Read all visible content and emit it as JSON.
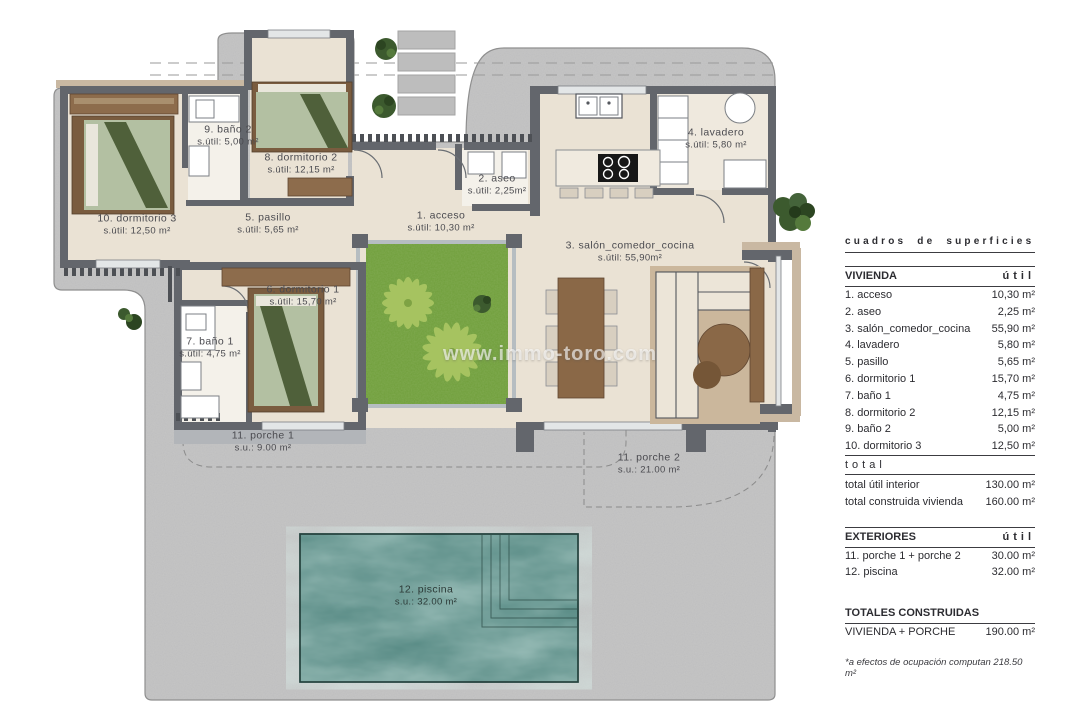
{
  "watermark": "www.immo-toro.com",
  "rooms": [
    {
      "label": "1. acceso",
      "area": "s.útil: 10,30 m²"
    },
    {
      "label": "2. aseo",
      "area": "s.útil: 2,25m²"
    },
    {
      "label": "3. salón_comedor_cocina",
      "area": "s.útil: 55,90m²"
    },
    {
      "label": "4. lavadero",
      "area": "s.útil: 5,80 m²"
    },
    {
      "label": "5. pasillo",
      "area": "s.útil: 5,65 m²"
    },
    {
      "label": "6. dormitorio 1",
      "area": "s.útil: 15,70 m²"
    },
    {
      "label": "7. baño 1",
      "area": "s.útil: 4,75 m²"
    },
    {
      "label": "8. dormitorio 2",
      "area": "s.útil: 12,15 m²"
    },
    {
      "label": "9. baño 2",
      "area": "s.útil: 5,00 m²"
    },
    {
      "label": "10. dormitorio 3",
      "area": "s.útil: 12,50 m²"
    },
    {
      "label": "11. porche 1",
      "area": "s.u.: 9.00 m²"
    },
    {
      "label": "11. porche 2",
      "area": "s.u.: 21.00 m²"
    },
    {
      "label": "12. piscina",
      "area": "s.u.: 32.00 m²"
    }
  ],
  "table": {
    "title": "cuadros de superficies",
    "vivienda": {
      "header": "VIVIENDA",
      "unit_header": "útil",
      "rows": [
        {
          "label": "1. acceso",
          "value": "10,30 m²"
        },
        {
          "label": "2. aseo",
          "value": "2,25 m²"
        },
        {
          "label": "3. salón_comedor_cocina",
          "value": "55,90 m²"
        },
        {
          "label": "4. lavadero",
          "value": "5,80 m²"
        },
        {
          "label": "5. pasillo",
          "value": "5,65 m²"
        },
        {
          "label": "6. dormitorio 1",
          "value": "15,70 m²"
        },
        {
          "label": "7. baño 1",
          "value": "4,75 m²"
        },
        {
          "label": "8. dormitorio 2",
          "value": "12,15 m²"
        },
        {
          "label": "9. baño 2",
          "value": "5,00 m²"
        },
        {
          "label": "10. dormitorio 3",
          "value": "12,50 m²"
        }
      ]
    },
    "total_word": "total",
    "totals": [
      {
        "label": "total útil interior",
        "value": "130.00 m²"
      },
      {
        "label": "total construida vivienda",
        "value": "160.00 m²"
      }
    ],
    "exteriores": {
      "header": "EXTERIORES",
      "unit_header": "útil",
      "rows": [
        {
          "label": "11. porche 1 + porche 2",
          "value": "30.00 m²"
        },
        {
          "label": "12. piscina",
          "value": "32.00 m²"
        }
      ]
    },
    "totales_construidas": {
      "header": "TOTALES CONSTRUIDAS",
      "rows": [
        {
          "label": "VIVIENDA + PORCHE",
          "value": "190.00 m²"
        }
      ]
    },
    "footnote": "*a efectos de ocupación computan 218.50 m²"
  },
  "colors": {
    "plot_gray": "#c6c6c6",
    "wall": "#63666c",
    "floor": "#eae2d4",
    "wood": "#8a6847",
    "bed_green": "#b3c0a2",
    "patio_green": "#6f9e3a",
    "pool_teal": "#4e837d",
    "tan": "#c9b8a2"
  }
}
